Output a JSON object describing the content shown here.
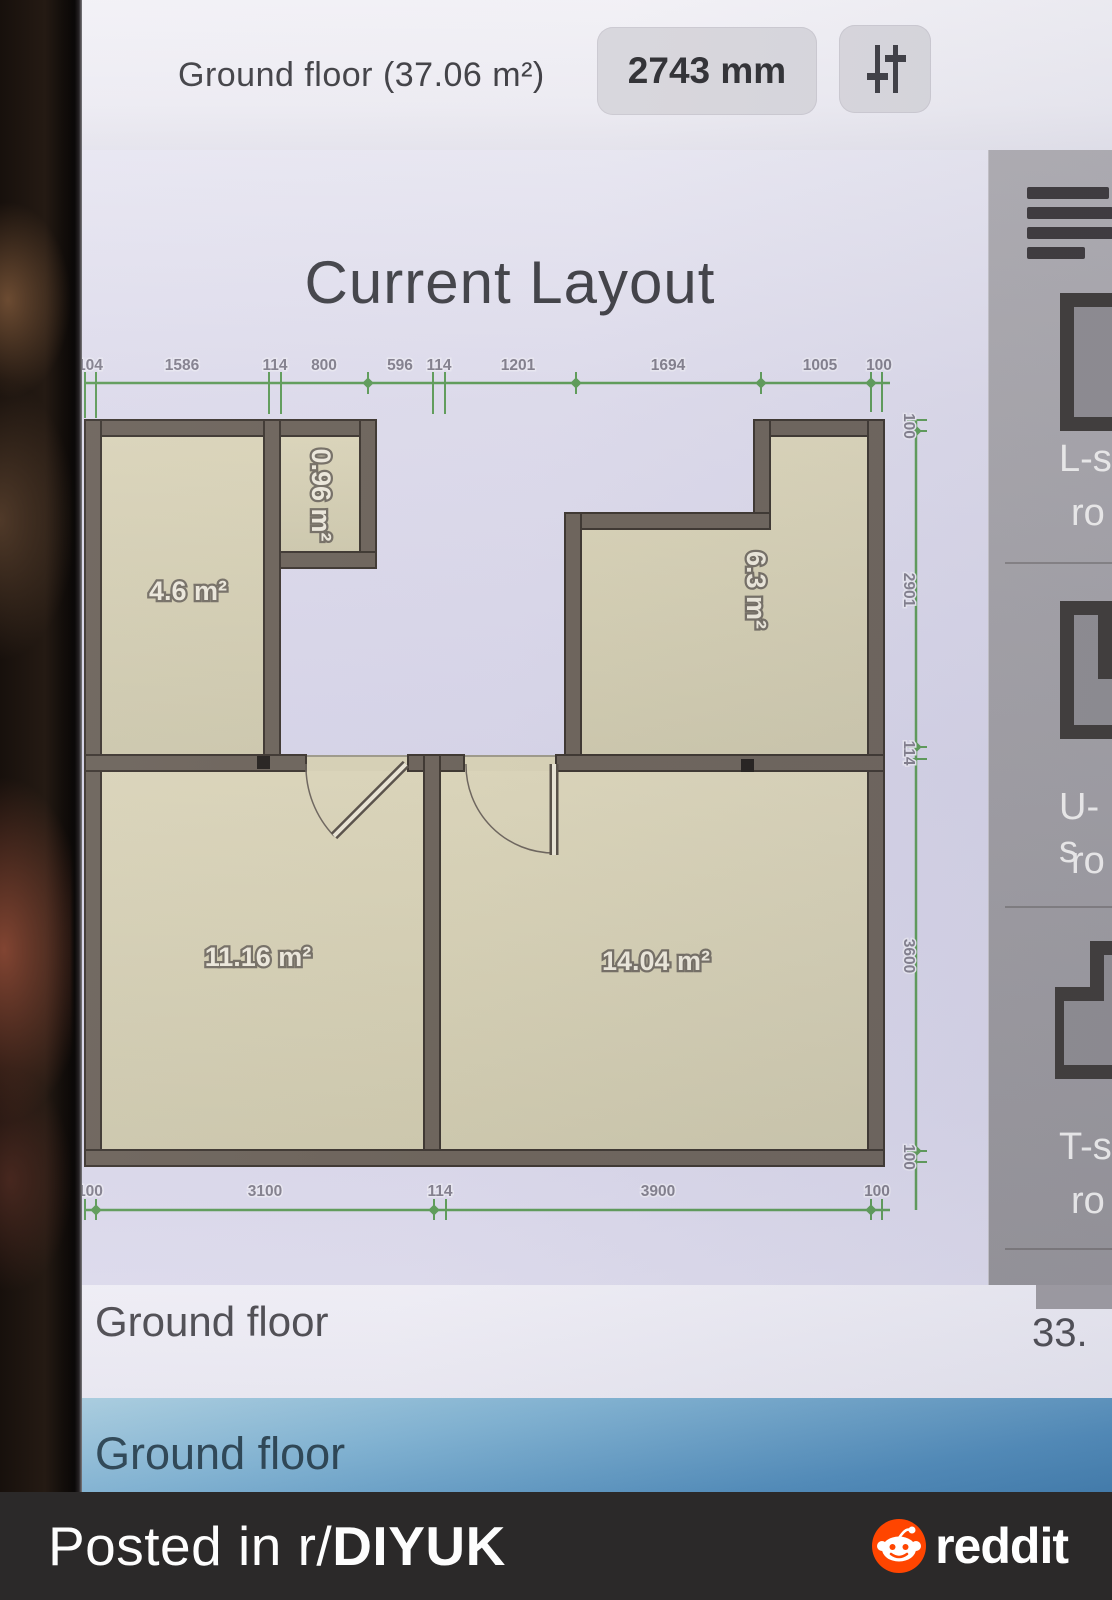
{
  "header": {
    "title": "Ground floor (37.06 m²)",
    "measure_button": "2743 mm"
  },
  "plan": {
    "title": "Current Layout",
    "rooms": [
      {
        "label": "4.6 m²"
      },
      {
        "label": "0.96 m²"
      },
      {
        "label": "6.3 m²"
      },
      {
        "label": "11.16 m²"
      },
      {
        "label": "14.04 m²"
      }
    ],
    "dims_top": [
      "104",
      "1586",
      "114",
      "800",
      "596",
      "114",
      "1201",
      "1694",
      "1005",
      "100"
    ],
    "dims_right": [
      "100",
      "2901",
      "114",
      "3600",
      "100"
    ],
    "dims_bottom": [
      "100",
      "3100",
      "114",
      "3900",
      "100"
    ],
    "colors": {
      "dimension_green": "#5c9b54",
      "wall_brown": "#6b6156",
      "floor_beige": "#d7d0b1",
      "reddit_orange": "#ff4500"
    }
  },
  "sidebar": {
    "items": [
      {
        "line1": "L-s",
        "line2": "ro"
      },
      {
        "line1": "U-s",
        "line2": "ro"
      },
      {
        "line1": "T-s",
        "line2": "ro"
      }
    ]
  },
  "floor_row": {
    "label": "Ground floor",
    "value": "33."
  },
  "floor_tab": {
    "label": "Ground floor"
  },
  "footer": {
    "posted_prefix": "Posted in r/",
    "subreddit": "DIYUK",
    "brand": "reddit"
  }
}
